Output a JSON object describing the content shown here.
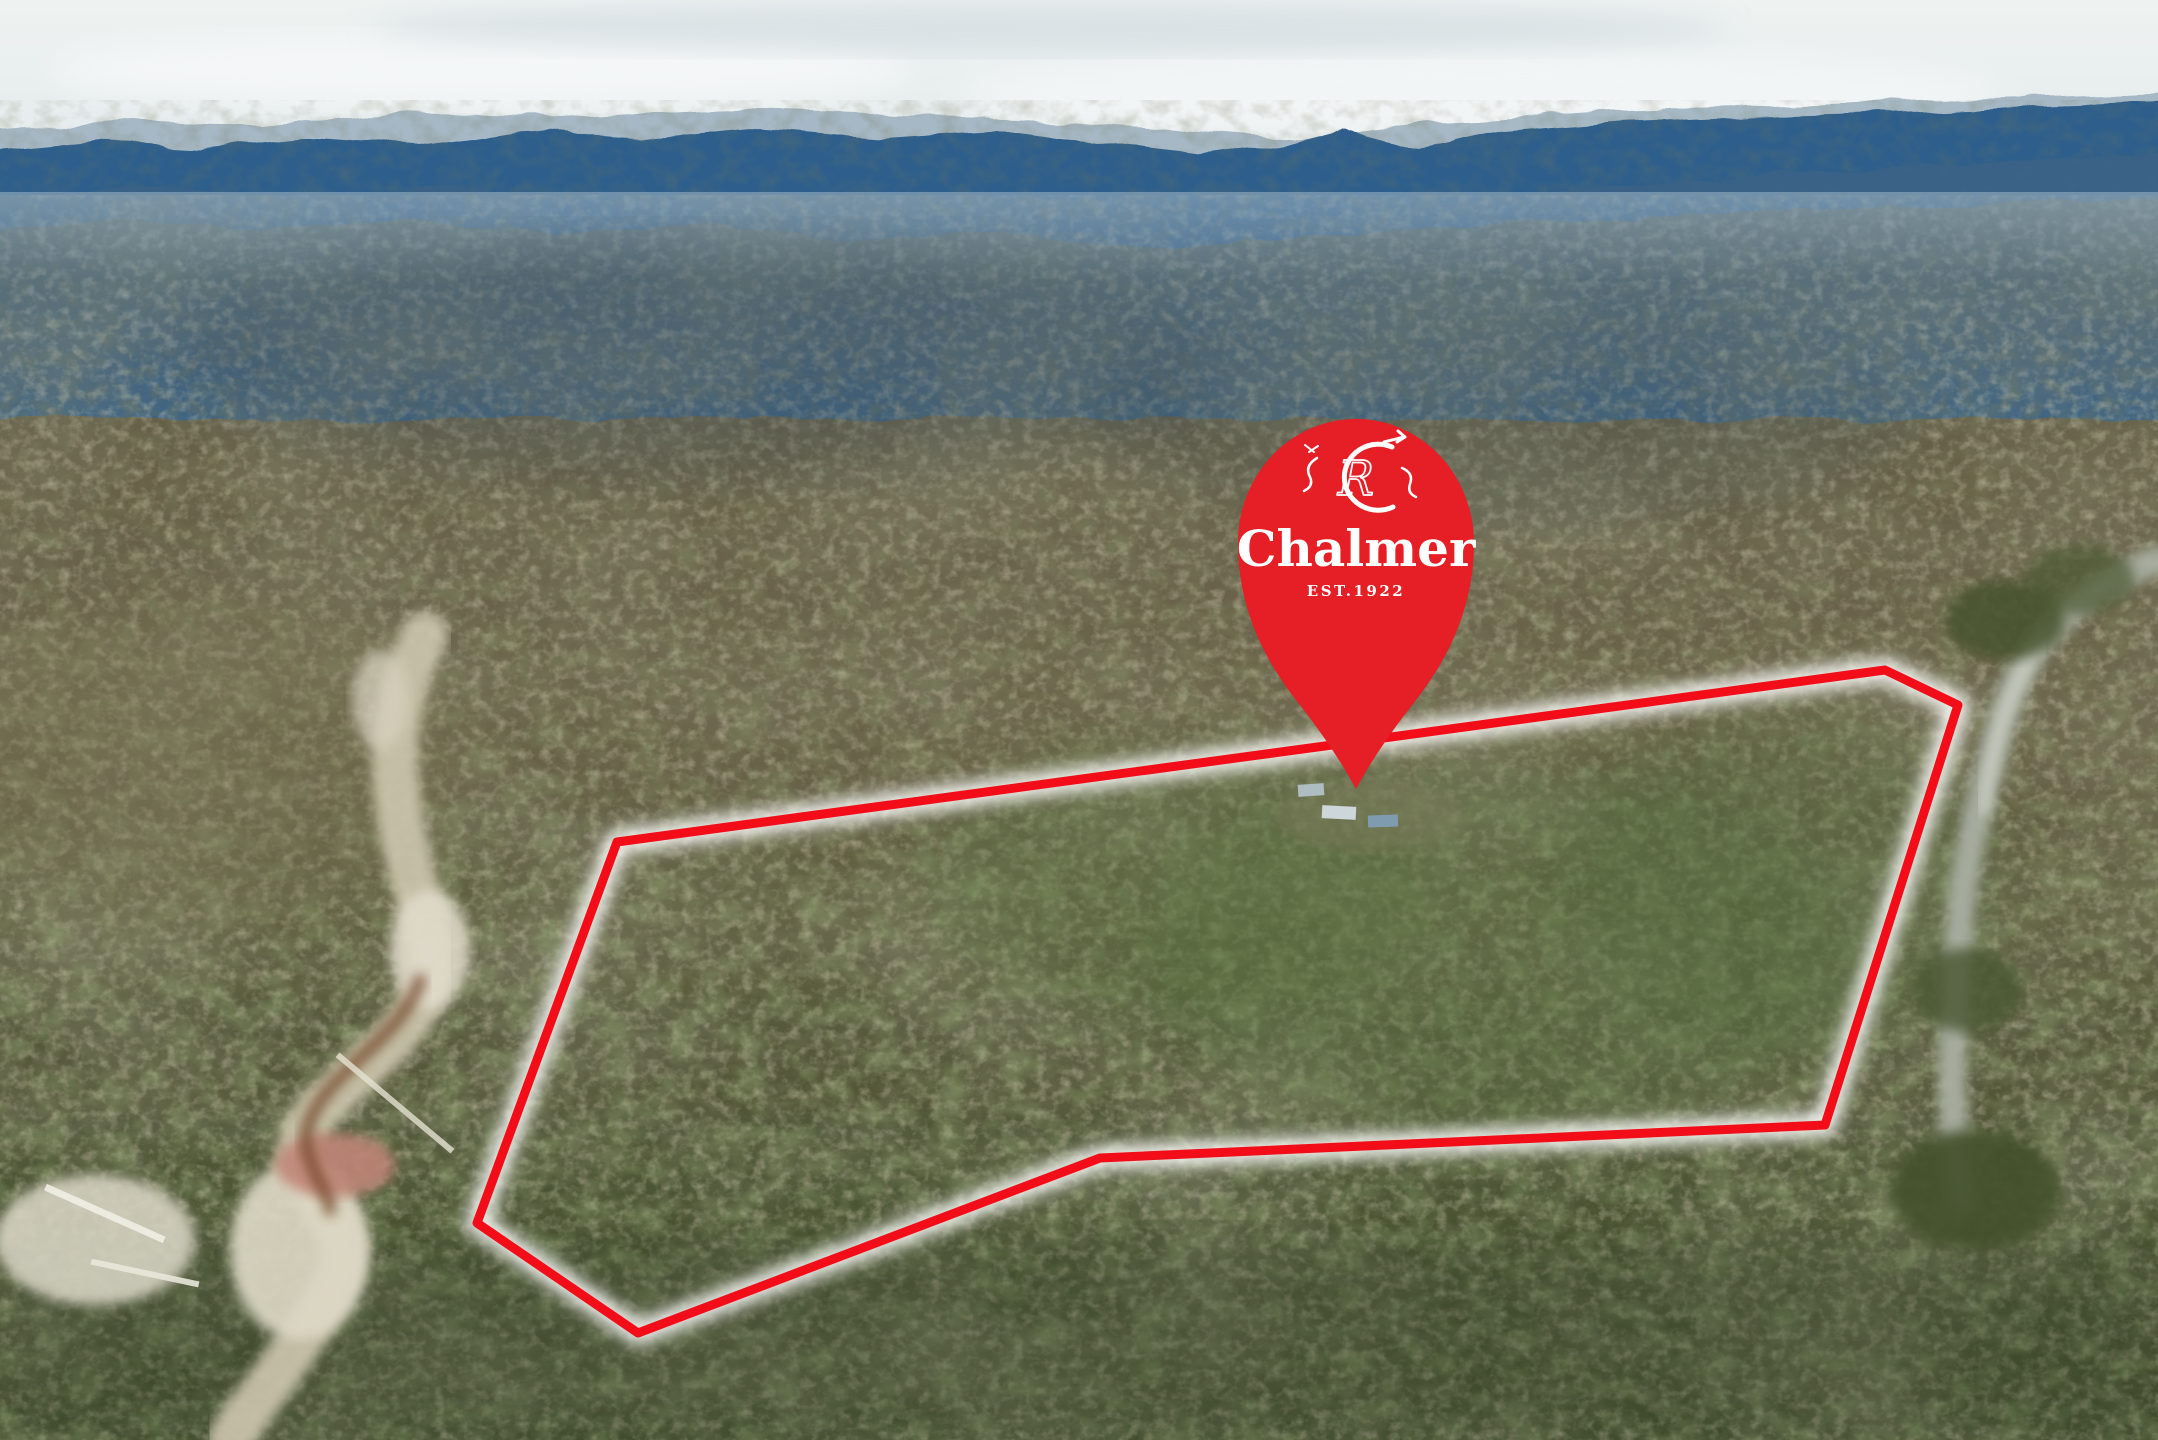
{
  "brand": {
    "name": "Chalmer",
    "established": "EST.1922"
  },
  "pin": {
    "label": "Chalmer",
    "sub_label": "EST.1922",
    "icon": "location-pin-icon",
    "monogram_icon": "chalmer-cr-monogram-icon"
  },
  "overlay": {
    "boundary_points": "617,842 1885,670 1958,705 1825,1125 1100,1158 638,1333 477,1223"
  },
  "colors": {
    "pin_red": "#e61e26",
    "boundary_red": "#f20d18",
    "glow_white": "#ffffff",
    "text_white": "#ffffff"
  }
}
